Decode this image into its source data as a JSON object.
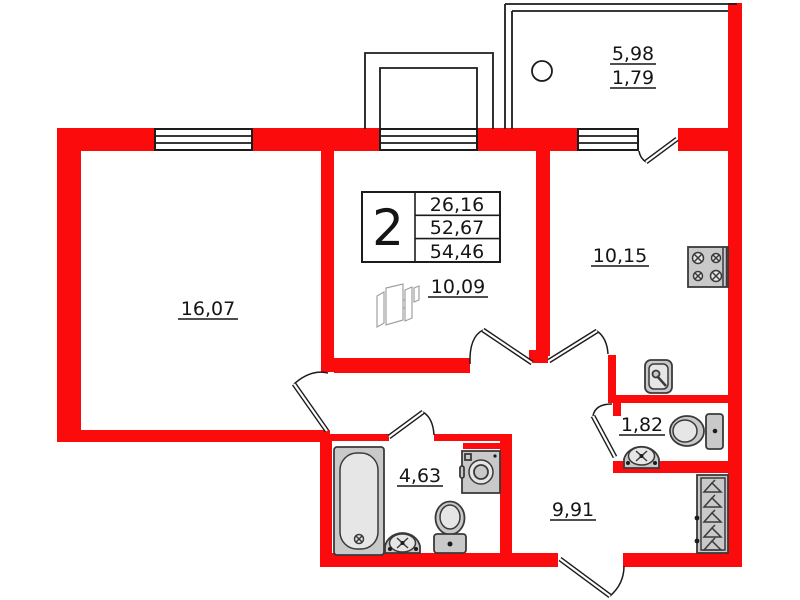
{
  "plan_summary": {
    "rooms_count": "2",
    "living_area": "26,16",
    "apartment_area": "52,67",
    "total_area": "54,46"
  },
  "room_labels": {
    "living_room": "16,07",
    "hall": "10,09",
    "kitchen": "10,15",
    "balcony_full": "5,98",
    "balcony_reduced": "1,79",
    "wc": "1,82",
    "bathroom": "4,63",
    "hallway": "9,91"
  },
  "colors": {
    "wall_red": "#fb0b0b",
    "fixture_gray": "#c9c9c9",
    "line_black": "#1c1c1c"
  }
}
